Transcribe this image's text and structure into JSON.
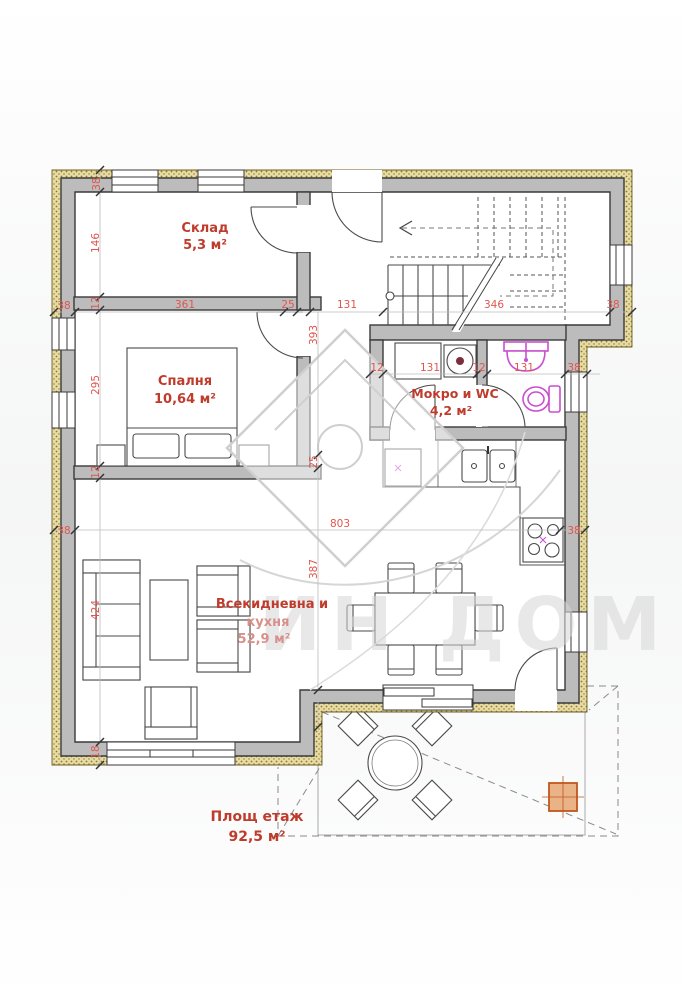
{
  "title": "Етажен план",
  "rooms": [
    {
      "label": "Склад",
      "area": "5,3 м²"
    },
    {
      "label": "Спалня",
      "area": "10,64 м²"
    },
    {
      "label": "Мокро и WC",
      "area": "4,2 м²"
    },
    {
      "label": "Всекидневна и",
      "label2": "кухня",
      "area": "52,9 м²"
    }
  ],
  "floor": {
    "label": "Площ етаж",
    "area": "92,5 м²"
  },
  "watermark": {
    "text": "ИН ДОМ"
  },
  "dims": {
    "top_wall": "38",
    "storage_h": "146",
    "int_a": "12",
    "bedroom_h": "295",
    "int_b": "12",
    "sofa_wall": "424",
    "bottom18": "18",
    "left38a": "38",
    "left38b": "38",
    "storage_w": "361",
    "stub25": "25",
    "hall131": "131",
    "stairs_w": "346",
    "right38": "38",
    "hall_len": "393",
    "bed25": "25",
    "living387": "387",
    "wc12a": "12",
    "wc131a": "131",
    "wc12b": "12",
    "wc131b": "131",
    "wc38": "38",
    "living_w": "803",
    "stove38": "38"
  },
  "colors": {
    "dimension_text": "#e0564e",
    "room_label": "#bf3b2c",
    "plumbing_fixture": "#c94fd0",
    "wall_fill": "#bcbcbc",
    "insulation": "#e8dba4",
    "column_accent": "#c2561c"
  }
}
